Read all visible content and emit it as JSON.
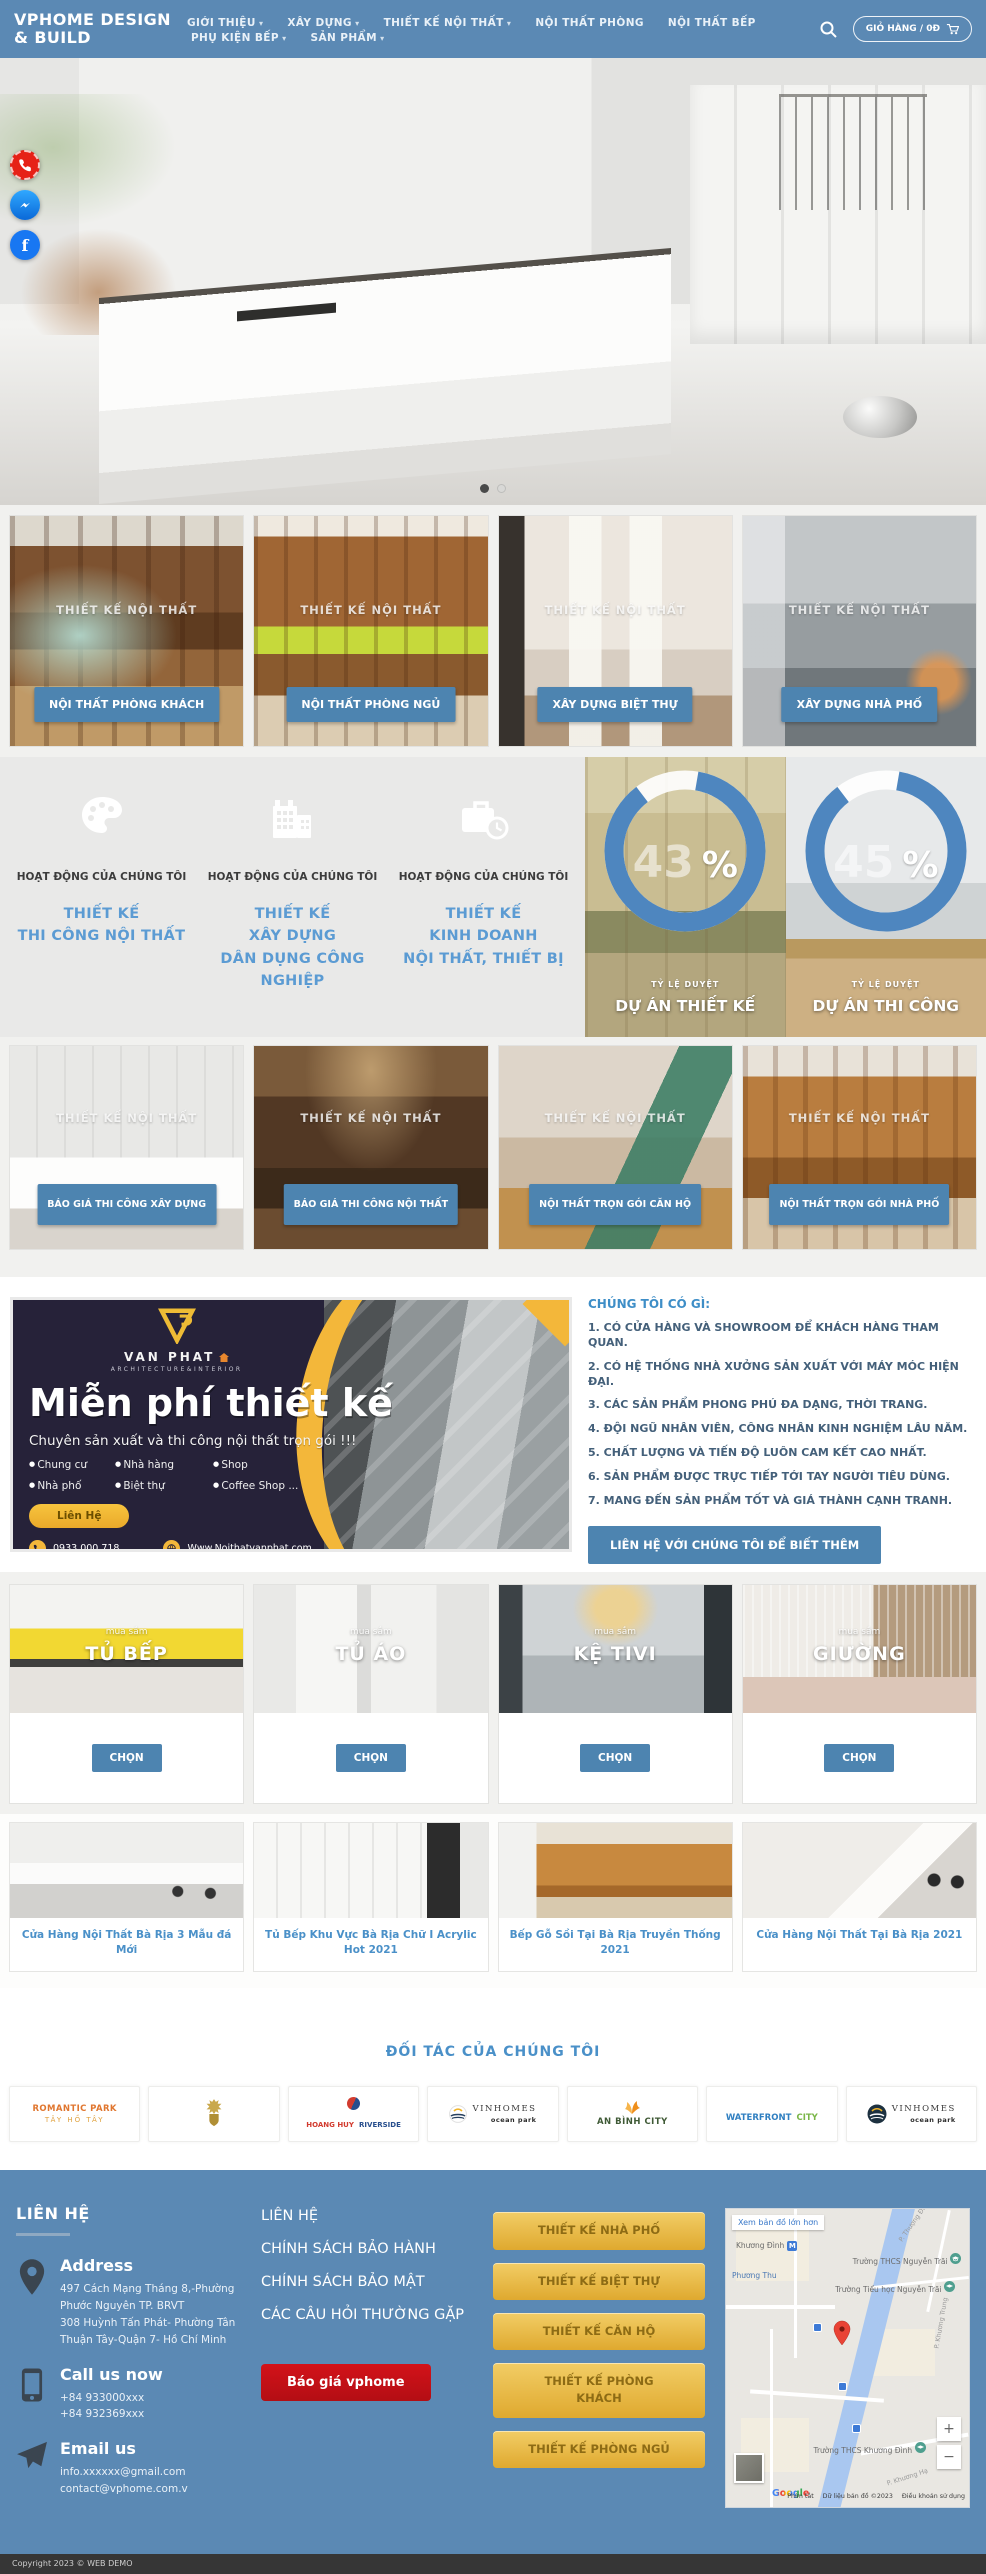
{
  "colors": {
    "primary_blue": "#5b89b4",
    "button_blue": "#4d84b0",
    "link_blue": "#4a90c8",
    "accent_yellow": "#f3b73a",
    "alert_red": "#c41017",
    "banner_navy": "#262239"
  },
  "header": {
    "logo_line1": "VPHOME DESIGN",
    "logo_line2": "& BUILD",
    "nav": [
      {
        "label": "GIỚI THIỆU"
      },
      {
        "label": "XÂY DỰNG"
      },
      {
        "label": "THIẾT KẾ NỘI THẤT"
      },
      {
        "label": "NỘI THẤT PHÒNG"
      },
      {
        "label": "NỘI THẤT BẾP"
      },
      {
        "label": "PHỤ KIỆN BẾP"
      },
      {
        "label": "SẢN PHẨM"
      }
    ],
    "cart_label": "GIỎ HÀNG / 0Đ"
  },
  "watermark": "THIẾT KẾ NỘI THẤT",
  "categories1": [
    {
      "button": "NỘI THẤT PHÒNG KHÁCH"
    },
    {
      "button": "NỘI THẤT PHÒNG NGỦ"
    },
    {
      "button": "XÂY DỰNG BIỆT THỰ"
    },
    {
      "button": "XÂY DỰNG NHÀ PHỐ"
    }
  ],
  "activities": {
    "title": "HOẠT ĐỘNG CỦA CHÚNG TÔI",
    "items": [
      {
        "icon": "palette-icon",
        "lines": [
          "THIẾT KẾ",
          "THI CÔNG NỘI THẤT"
        ]
      },
      {
        "icon": "building-icon",
        "lines": [
          "THIẾT KẾ",
          "XÂY DỰNG",
          "DÂN DỤNG CÔNG NGHIỆP"
        ]
      },
      {
        "icon": "briefcase-clock-icon",
        "lines": [
          "THIẾT KẾ",
          "KINH DOANH",
          "NỘI THẤT, THIẾT BỊ"
        ]
      }
    ]
  },
  "stats": [
    {
      "value": "43",
      "unit": "%",
      "rate_label": "TỶ LỆ DUYỆT",
      "name": "DỰ ÁN THIẾT KẾ"
    },
    {
      "value": "45",
      "unit": "%",
      "rate_label": "TỶ LỆ DUYỆT",
      "name": "DỰ ÁN THI CÔNG"
    }
  ],
  "chart_data": [
    {
      "type": "pie",
      "title": "TỶ LỆ DUYỆT — DỰ ÁN THIẾT KẾ",
      "labels": [
        "Duyệt",
        "Còn lại"
      ],
      "values": [
        43,
        57
      ],
      "unit": "%",
      "legend_position": "none"
    },
    {
      "type": "pie",
      "title": "TỶ LỆ DUYỆT — DỰ ÁN THI CÔNG",
      "labels": [
        "Duyệt",
        "Còn lại"
      ],
      "values": [
        45,
        55
      ],
      "unit": "%",
      "legend_position": "none"
    }
  ],
  "categories2": [
    {
      "button": "BÁO GIÁ THI CÔNG XÂY DỰNG"
    },
    {
      "button": "BÁO GIÁ THI CÔNG NỘI THẤT"
    },
    {
      "button": "NỘI THẤT TRỌN GÓI CĂN HỘ"
    },
    {
      "button": "NỘI THẤT TRỌN GÓI NHÀ PHỐ"
    }
  ],
  "banner": {
    "brand": "VAN PHAT",
    "brand_sub": "ARCHITECTURE&INTERIOR",
    "title": "Miễn phí thiết kế",
    "subtitle": "Chuyên sản xuất và thi công nội thất trọn gói !!!",
    "bullets": [
      "Chung cư",
      "Nhà hàng",
      "Shop",
      "Nhà phố",
      "Biệt thự",
      "Coffee Shop ..."
    ],
    "cta": "Liên Hệ",
    "phone": "0933.000.718",
    "website": "Www.Noithatvanphat.com",
    "address": "497 Cách Mạng Tháng 8, Phước Nguyên, TP Bà Rịa"
  },
  "about": {
    "heading": "CHÚNG TÔI CÓ GÌ:",
    "items": [
      "1. CÓ CỬA HÀNG VÀ SHOWROOM ĐỂ KHÁCH HÀNG THAM QUAN.",
      "2. CÓ HỆ THỐNG NHÀ XƯỞNG SẢN XUẤT VỚI MÁY MÓC HIỆN ĐẠI.",
      "3. CÁC SẢN PHẨM PHONG PHÚ ĐA DẠNG, THỜI TRANG.",
      "4. ĐỘI NGŨ NHÂN VIÊN, CÔNG NHÂN KINH NGHIỆM LÂU NĂM.",
      "5. CHẤT LƯỢNG VÀ TIẾN ĐỘ LUÔN CAM KẾT CAO NHẤT.",
      "6. SẢN PHẨM ĐƯỢC TRỰC TIẾP TỚI TAY NGƯỜI TIÊU DÙNG.",
      "7. MANG ĐẾN SẢN PHẨM TỐT VÀ GIÁ THÀNH CẠNH TRANH."
    ],
    "button": "LIÊN HỆ VỚI CHÚNG TÔI ĐỂ BIẾT THÊM"
  },
  "products": {
    "tag": "mua sắm",
    "choose": "CHỌN",
    "items": [
      {
        "name": "TỦ BẾP"
      },
      {
        "name": "TỦ ÁO"
      },
      {
        "name": "KỆ TIVI"
      },
      {
        "name": "GIƯỜNG"
      }
    ]
  },
  "articles": [
    {
      "title": "Cửa Hàng Nội Thất Bà Rịa 3 Mẫu đá Mới"
    },
    {
      "title": "Tủ Bếp Khu Vực Bà Rịa Chữ I Acrylic Hot 2021"
    },
    {
      "title": "Bếp Gỗ Sồi Tại Bà Rịa Truyền Thống 2021"
    },
    {
      "title": "Cửa Hàng Nội Thất Tại Bà Rịa 2021"
    }
  ],
  "partners": {
    "heading": "ĐỐI TÁC CỦA CHÚNG TÔI",
    "items": [
      {
        "line1": "ROMANTIC PARK",
        "line2": "TÂY HỒ TÂY"
      },
      {
        "line1": "",
        "line2": ""
      },
      {
        "line1": "HOANG HUY",
        "line2": "RIVERSIDE"
      },
      {
        "line1": "VINHOMES",
        "line2": "ocean park"
      },
      {
        "line1": "AN BÌNH CITY",
        "line2": ""
      },
      {
        "line1": "WATERFRONT",
        "line2": "CITY"
      },
      {
        "line1": "VINHOMES",
        "line2": "ocean park"
      }
    ]
  },
  "footer": {
    "contact_heading": "LIÊN HỆ",
    "address_title": "Address",
    "address_lines": [
      "497 Cách Mạng Tháng 8,-Phường Phước Nguyên TP. BRVT",
      "308 Huỳnh Tấn Phát- Phường Tân Thuận Tây-Quận 7- Hồ Chí Minh"
    ],
    "call_title": "Call us now",
    "phones": [
      "+84 933000xxx",
      "+84 932369xxx"
    ],
    "email_title": "Email us",
    "emails": [
      "info.xxxxxx@gmail.com",
      "contact@vphome.com.v"
    ],
    "links": [
      "LIÊN HỆ",
      "CHÍNH SÁCH BẢO HÀNH",
      "CHÍNH SÁCH BẢO MẬT",
      "CÁC CÂU HỎI THƯỜNG GẶP"
    ],
    "quote_button": "Báo giá vphome",
    "design_buttons": [
      "THIẾT KẾ NHÀ PHỐ",
      "THIẾT KẾ BIỆT THỰ",
      "THIẾT KẾ CĂN HỘ",
      "THIẾT KẾ PHÒNG KHÁCH",
      "THIẾT KẾ PHÒNG NGỦ"
    ]
  },
  "map": {
    "enlarge_link": "Xem bản đồ lớn hơn",
    "metro_label": "M",
    "labels": {
      "area1": "Khương Đình",
      "area2": "Phương Thu",
      "school1": "Trường THCS Nguyễn Trãi",
      "school2": "Trường Tiểu học Nguyễn Trãi",
      "school3": "Trường THCS Khương Đình",
      "street1": "P. Thượng Đình",
      "street2": "P. Khương Trung",
      "street3": "P. Khương Hạ"
    },
    "google": "Google",
    "zoom_in": "+",
    "zoom_out": "−",
    "attribution": [
      "Phím tắt",
      "Dữ liệu bản đồ ©2023",
      "Điều khoản sử dụng"
    ]
  },
  "social": {
    "facebook_glyph": "f"
  },
  "copyright": "Copyright 2023 © WEB DEMO"
}
